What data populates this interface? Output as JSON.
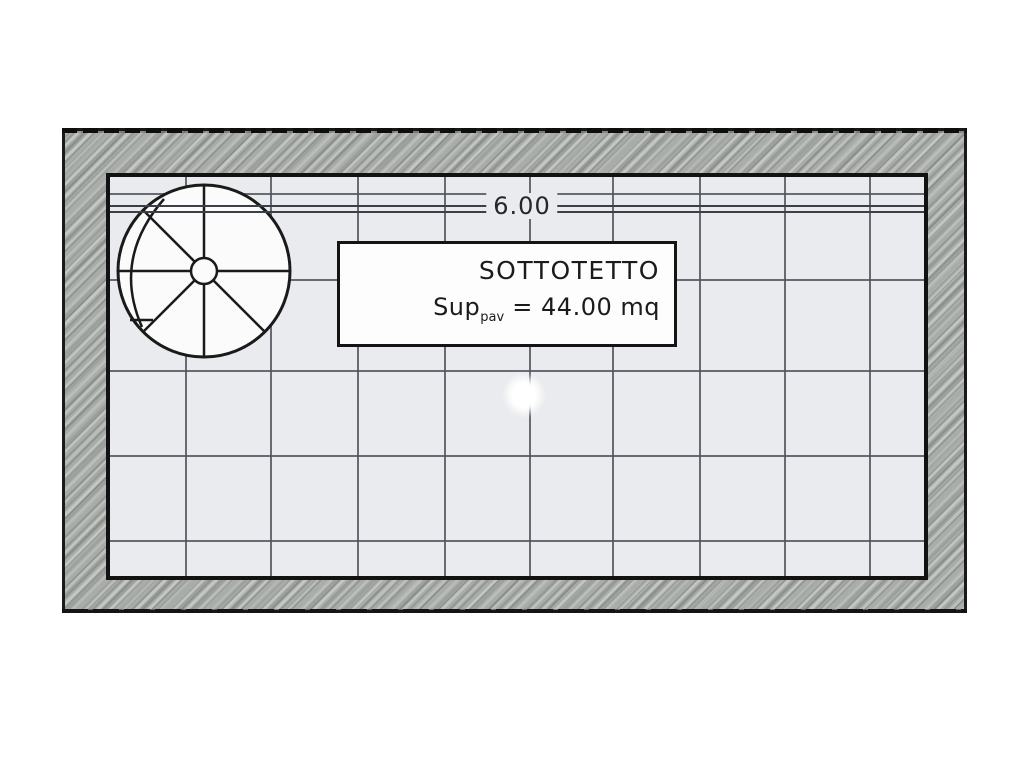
{
  "plan": {
    "room_name": "SOTTOTETTO",
    "area": {
      "prefix": "Sup",
      "sub": "pav",
      "value": " = 44.00 mq"
    },
    "dimension_width": "6.00",
    "grid": {
      "vertical_x": [
        75,
        160,
        247,
        334,
        419,
        502,
        589,
        674,
        759
      ],
      "horizontal_y": [
        16,
        102,
        193,
        278,
        363
      ]
    },
    "dim_line_y": [
      28,
      34
    ],
    "colors": {
      "wall_base": "#a9ada9",
      "room_fill": "#e9ebee",
      "grid_line": "#50555d",
      "ink": "#1a1a1a"
    }
  }
}
